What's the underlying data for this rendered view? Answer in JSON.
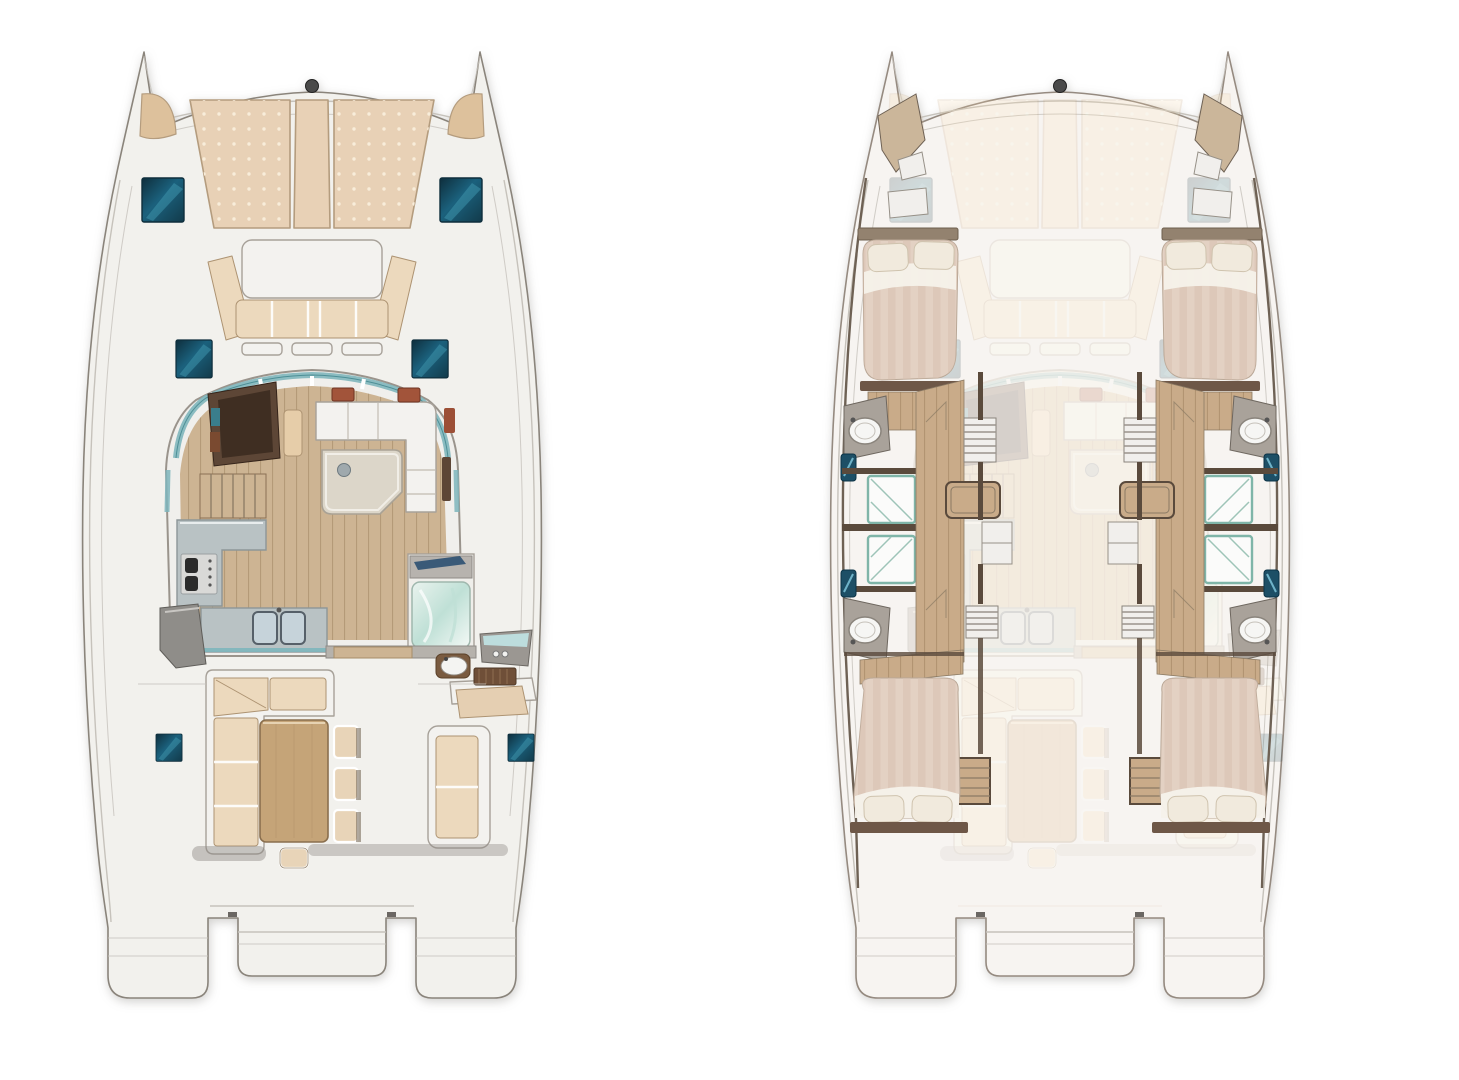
{
  "page": {
    "title": "Catamaran layout plans — deck view and hull cabins view",
    "background": "#ffffff"
  },
  "render": {
    "ghost_opacity": "0.18"
  },
  "palette": {
    "deck": "#f2f1ed",
    "deckStroke": "#8a847b",
    "deckRight": "#f7f4f1",
    "deckStrokeRight": "#958a80",
    "line": "#c6c2bb",
    "white": "#f3f2ef",
    "frame": "#a7a199",
    "cornerPad": "#ddc19c",
    "pad": "#e8d1b6",
    "padDot": "#f8edda",
    "padEdge": "#b49c7e",
    "cushion": "#ecd9bd",
    "cushionEdge": "#ad9372",
    "hatchDeep": "#0e2e3c",
    "hatchMid": "#1b617d",
    "hatchDim": "#123a4a",
    "hatchLight": "#3e93ac",
    "wood": "#cdb493",
    "woodLine": "#8c6e4b",
    "darkWood": "#5d4636",
    "navPanel": "#3f2e22",
    "table": "#dcd6c9",
    "tableEdge": "#a9a295",
    "cockpitTable": "#c5a478",
    "cockpitTableEdge": "#8a6f4e",
    "counter": "#b9c2c4",
    "counterEdge": "#8d9698",
    "steel": "#c6d3da",
    "steelEdge": "#566069",
    "glass": "#7fb6bd",
    "glassEdge": "#4d8f96",
    "fridge": "#8f8d89",
    "red": "#a2543a",
    "chair": "#e8d4b8",
    "chairShadow": "#6f614f",
    "helm": "#9b9792",
    "showerA": "#eaf3ee",
    "showerB": "#bfe0d6",
    "navyGlass": "#3a5a78",
    "hullWood": "#c9ab89",
    "hullWall": "#5a4a3c",
    "hullWallSoft": "#6e6154",
    "mattress": "#e3d1c3",
    "mattressStripe": "#d6bfaf",
    "pillow": "#f1eadd",
    "sheet": "#f6f2ea",
    "headboard": "#93826f",
    "footboard": "#6e5747",
    "showerFrame": "#7fb5a8",
    "showerLine": "#9ec4b8",
    "mirrorTeal": "#1d4f66",
    "mirrorStreak": "#6fb3c9",
    "bowWedge": "#cbb69a",
    "cabinet": "#f1efec",
    "cabinetEdge": "#979188",
    "counterGray": "#a9a29a",
    "sinkWhite": "#f6f6f4",
    "beamFitting": "#4a4a4a"
  },
  "boats": [
    {
      "id": "deck-plan",
      "label": "Main deck layout: foredeck sunpads, forward cockpit, saloon with galley, aft cockpit dining",
      "position": "left"
    },
    {
      "id": "hull-plan",
      "label": "Hull accommodations layout: 4 double cabins and 4 shower rooms, deck plan ghosted",
      "position": "right"
    }
  ],
  "deck_features": [
    "bow-sunpads",
    "bow-corner-pads",
    "forward-crossbeam",
    "deck-hatches",
    "forward-cockpit-bench",
    "forward-cockpit-table",
    "saloon-glazing",
    "chart-table",
    "nav-seat",
    "front-settee",
    "island-table",
    "galley-counter",
    "cooktop",
    "double-sink",
    "refrigerator",
    "shower-room",
    "cockpit-l-sofa",
    "cockpit-dining-table",
    "dining-chairs",
    "stool",
    "aft-bench",
    "helm-console",
    "cockpit-sink",
    "teak-step",
    "transom-steps",
    "swim-platform"
  ],
  "hull_features": [
    "forward-double-cabin-port",
    "forward-double-cabin-starboard",
    "aft-double-cabin-port",
    "aft-double-cabin-starboard",
    "shower-stall-x4",
    "washbasin-x4",
    "vanity-mirror-x4",
    "companionway-stairs",
    "wardrobe-shelves",
    "bow-storage",
    "hull-corridor"
  ]
}
